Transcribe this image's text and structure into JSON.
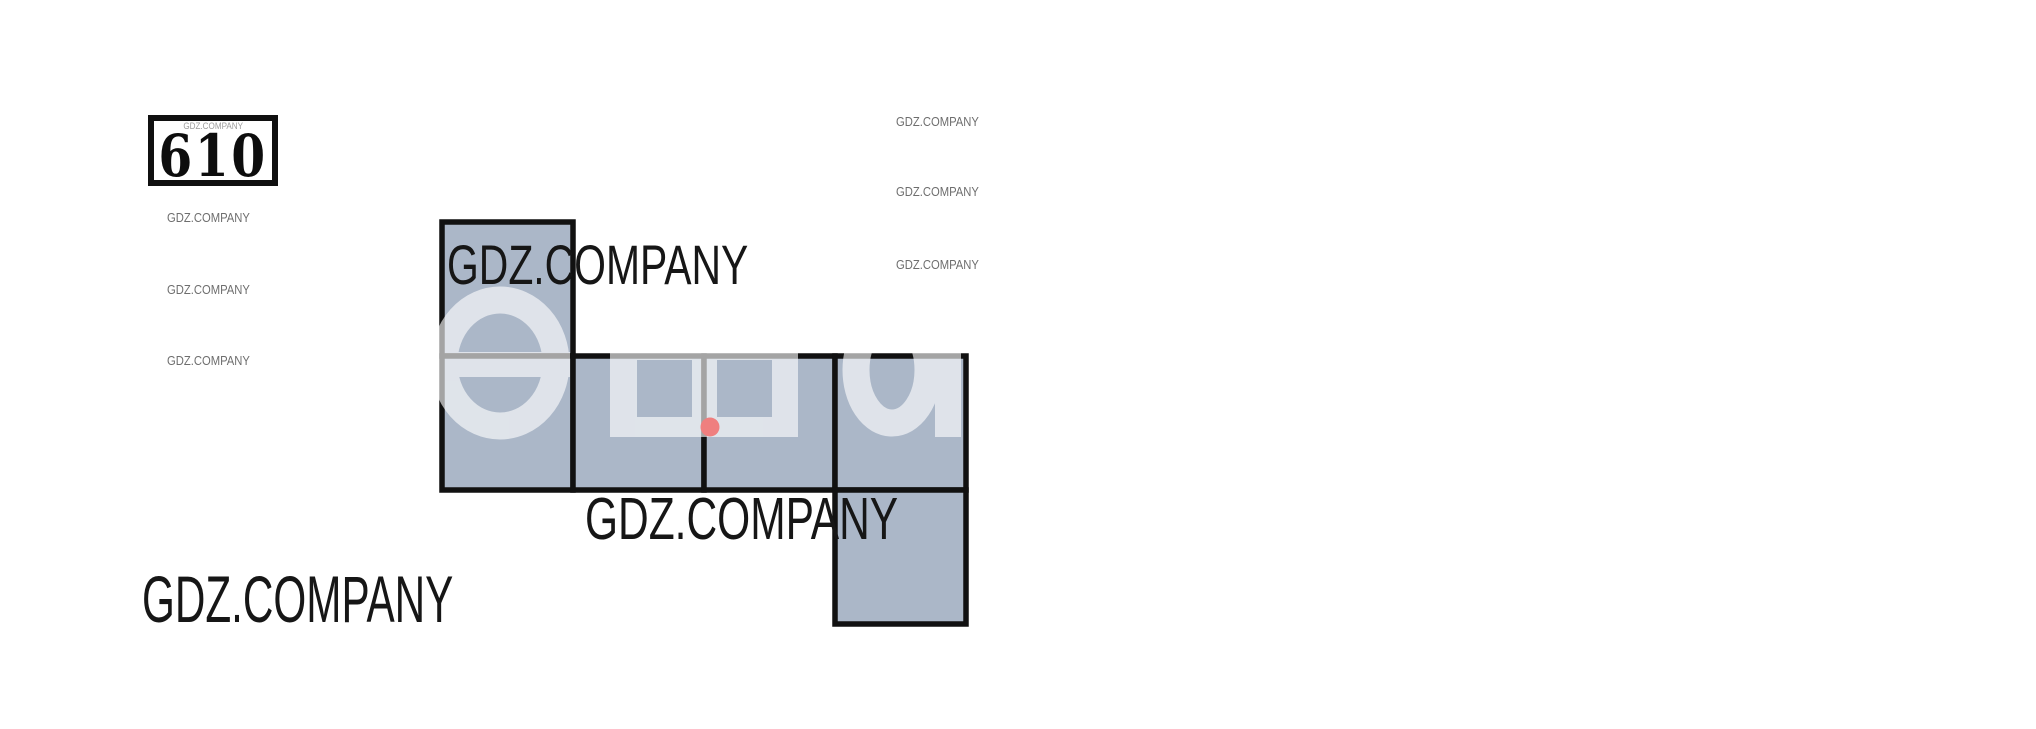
{
  "brand": {
    "label": "GDZ.COMPANY"
  },
  "problem": {
    "number": "610"
  },
  "watermarks": {
    "small_left_count": 3,
    "small_right_count": 3,
    "large_black_count": 3,
    "tiny_in_number_box": 1
  },
  "figure": {
    "type": "cube_net",
    "description": "Unfolded cube net of 6 equal squares with one marked point",
    "squares_count": 6,
    "origin": {
      "x": 442,
      "y": 222
    },
    "unit": {
      "w": 131,
      "h": 134
    },
    "cells": [
      [
        0,
        0
      ],
      [
        0,
        1
      ],
      [
        1,
        1
      ],
      [
        2,
        1
      ],
      [
        3,
        1
      ],
      [
        3,
        2
      ]
    ],
    "fill": "#abb7c8",
    "stroke": "#111111",
    "stroke_width": 5.5,
    "marked_point": {
      "cx": 710,
      "cy": 427,
      "r": 9.5,
      "color": "#ef7f7f"
    },
    "overlay": {
      "text": "еша",
      "fill": "#ffffff",
      "opacity": 0.62,
      "shapes": [
        {
          "kind": "ellipse-ring",
          "cx": 500,
          "cy": 363,
          "rx": 56,
          "ry": 63,
          "sw": 27
        },
        {
          "kind": "rect",
          "x": 436,
          "y": 352,
          "w": 134,
          "h": 25
        },
        {
          "kind": "holed-rect",
          "x": 610,
          "y": 294,
          "w": 188,
          "h": 143,
          "holes": [
            [
              637,
              360,
              55,
              57
            ],
            [
              717,
              360,
              55,
              57
            ]
          ]
        },
        {
          "kind": "ellipse-ring",
          "cx": 892,
          "cy": 370,
          "rx": 36,
          "ry": 53,
          "sw": 27
        },
        {
          "kind": "rect",
          "x": 935,
          "y": 298,
          "w": 26,
          "h": 139
        }
      ]
    }
  },
  "colors": {
    "background": "#ffffff",
    "cell_fill": "#abb7c8",
    "outline": "#111111",
    "marked_point": "#ef7f7f",
    "big_text": "#161616",
    "small_text": "#6e6e6e",
    "tiny_text": "#9c9c9c"
  }
}
